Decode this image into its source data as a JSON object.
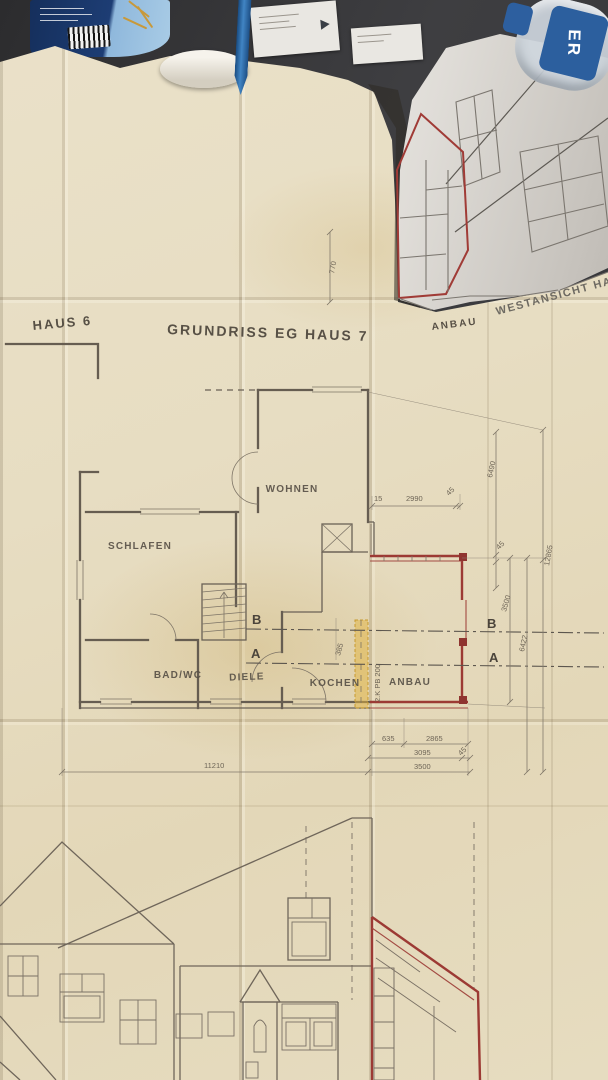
{
  "titles": {
    "haus6": "HAUS 6",
    "main": "GRUNDRISS EG HAUS 7",
    "anbau_plan": "ANBAU",
    "westansicht": "WESTANSICHT HA"
  },
  "rooms": {
    "wohnen": "WOHNEN",
    "schlafen": "SCHLAFEN",
    "bad_wc": "BAD/WC",
    "diele": "DIELE",
    "kochen": "KOCHEN",
    "anbau": "ANBAU"
  },
  "sections": {
    "a": "A",
    "b": "B"
  },
  "annotations": {
    "beam": "2.K PB 200"
  },
  "dimensions": {
    "d770": "770",
    "d15": "15",
    "d2990": "2990",
    "d45_top": "45",
    "d6490": "6490",
    "d12865": "12865",
    "d45_mid": "45",
    "d3500_right": "3500",
    "d6422": "6422",
    "d385": "385",
    "d635": "635",
    "d2865": "2865",
    "d3095": "3095",
    "d45_bottom": "45",
    "d3500_bottom": "3500",
    "d11210": "11210"
  },
  "scene": {
    "bottle_label": "ER"
  },
  "colors": {
    "paper": "#e7ddc2",
    "red_ink": "#9c3a34",
    "plan_ink": "#665d51",
    "highlight_yellow": "#e0b23c"
  }
}
